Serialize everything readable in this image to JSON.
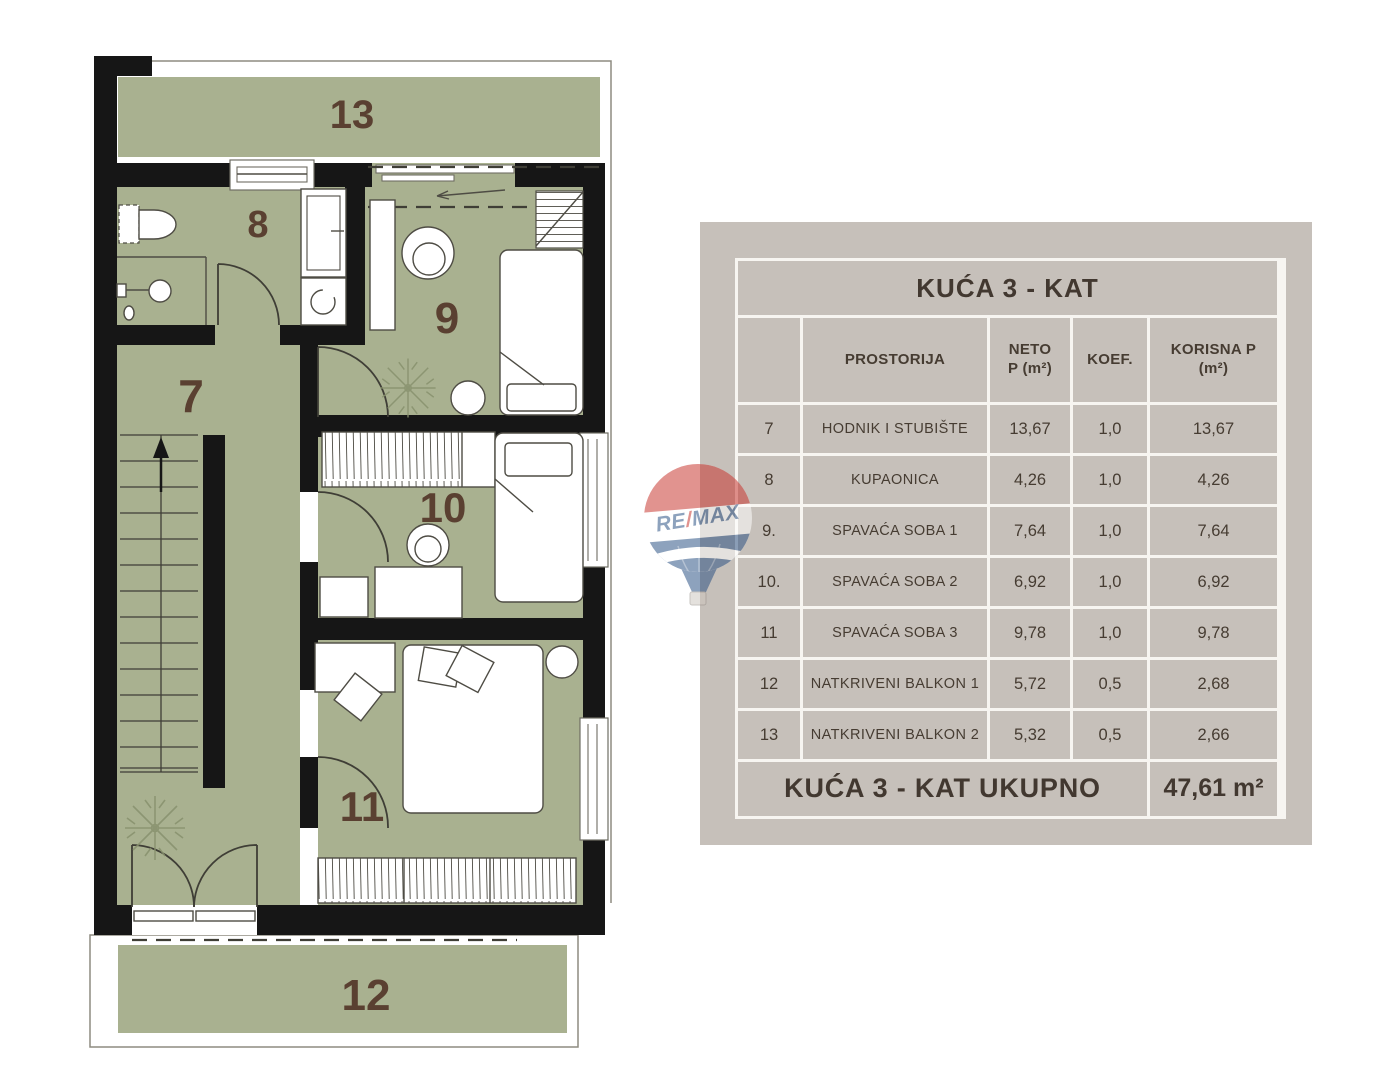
{
  "floor_plan": {
    "room_labels": {
      "7": "7",
      "8": "8",
      "9": "9",
      "10": "10",
      "11": "11",
      "12": "12",
      "13": "13"
    }
  },
  "table": {
    "title": "KUĆA 3 - KAT",
    "headers": {
      "num": "",
      "name": "PROSTORIJA",
      "neto_line1": "NETO",
      "neto_line2": "P (m²)",
      "koef": "KOEF.",
      "korisna_line1": "KORISNA P",
      "korisna_line2": "(m²)"
    },
    "rows": [
      {
        "num": "7",
        "name": "HODNIK I STUBIŠTE",
        "neto": "13,67",
        "koef": "1,0",
        "korisna": "13,67"
      },
      {
        "num": "8",
        "name": "KUPAONICA",
        "neto": "4,26",
        "koef": "1,0",
        "korisna": "4,26"
      },
      {
        "num": "9.",
        "name": "SPAVAĆA SOBA 1",
        "neto": "7,64",
        "koef": "1,0",
        "korisna": "7,64"
      },
      {
        "num": "10.",
        "name": "SPAVAĆA SOBA 2",
        "neto": "6,92",
        "koef": "1,0",
        "korisna": "6,92"
      },
      {
        "num": "11",
        "name": "SPAVAĆA SOBA 3",
        "neto": "9,78",
        "koef": "1,0",
        "korisna": "9,78"
      },
      {
        "num": "12",
        "name": "NATKRIVENI BALKON 1",
        "neto": "5,72",
        "koef": "0,5",
        "korisna": "2,68"
      },
      {
        "num": "13",
        "name": "NATKRIVENI BALKON 2",
        "neto": "5,32",
        "koef": "0,5",
        "korisna": "2,66"
      }
    ],
    "footer": {
      "label": "KUĆA 3 - KAT UKUPNO",
      "total": "47,61 m²"
    }
  },
  "logo": {
    "part1": "RE",
    "slash": "/",
    "part2": "MAX"
  },
  "colors": {
    "room_green": "#a9b190",
    "wall": "#161616",
    "table_panel": "#c6c0ba",
    "number_brown": "#5a4031",
    "text": "#463c32",
    "logo_red": "#c8342e",
    "logo_blue": "#2a5083"
  }
}
